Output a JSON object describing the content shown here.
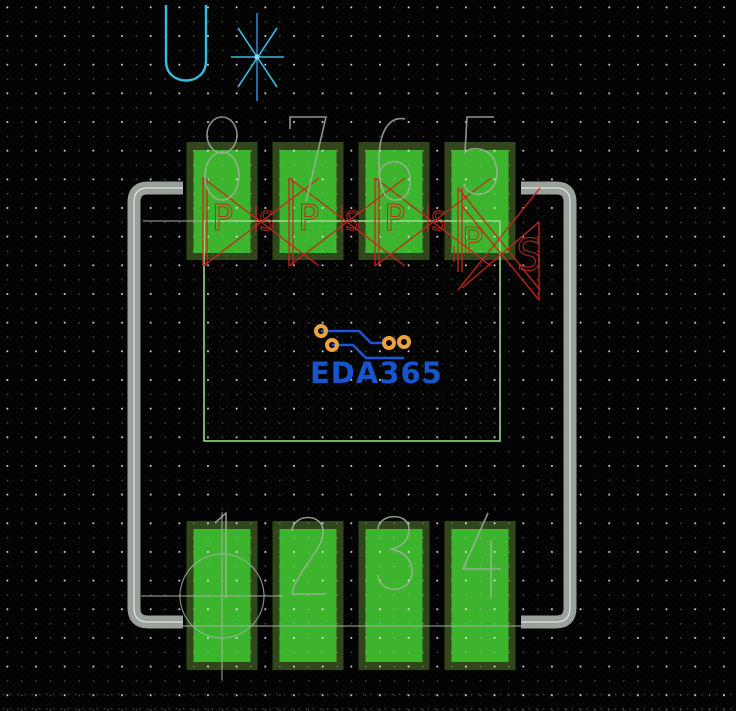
{
  "window": {
    "width": 736,
    "height": 711,
    "background": "#000000",
    "grid": "dot"
  },
  "refdes": {
    "label": "U*"
  },
  "origin_symbol": "*",
  "footprint": {
    "pins_top": [
      "8",
      "7",
      "6",
      "5"
    ],
    "pins_bottom": [
      "1",
      "2",
      "3",
      "4"
    ],
    "pin_count": 8,
    "pin1_indicator": "circle"
  },
  "logo": {
    "text": "EDA365"
  },
  "drc": {
    "pad_letters": [
      "P",
      "P",
      "P",
      "P"
    ],
    "gap_letters": [
      "S",
      "S",
      "S"
    ],
    "side_letter": "S"
  },
  "colors": {
    "background": "#000000",
    "pad_bright": "#3cb42d",
    "pad_dark": "#31471b",
    "silkscreen_gray": "#9aa09a",
    "silkscreen_highlight": "#e0e4e0",
    "outline_green": "#96d88a",
    "annotation_sage": "#9fb39b",
    "drc_red": "#c5271c",
    "refdes_cyan": "#38bcdc",
    "refdes_blue": "#2c85cc",
    "logo_blue": "#1556cf",
    "trace_blue": "#1b55d8",
    "donut_orange": "#eda33d",
    "grid_dot": "#ffffff"
  }
}
